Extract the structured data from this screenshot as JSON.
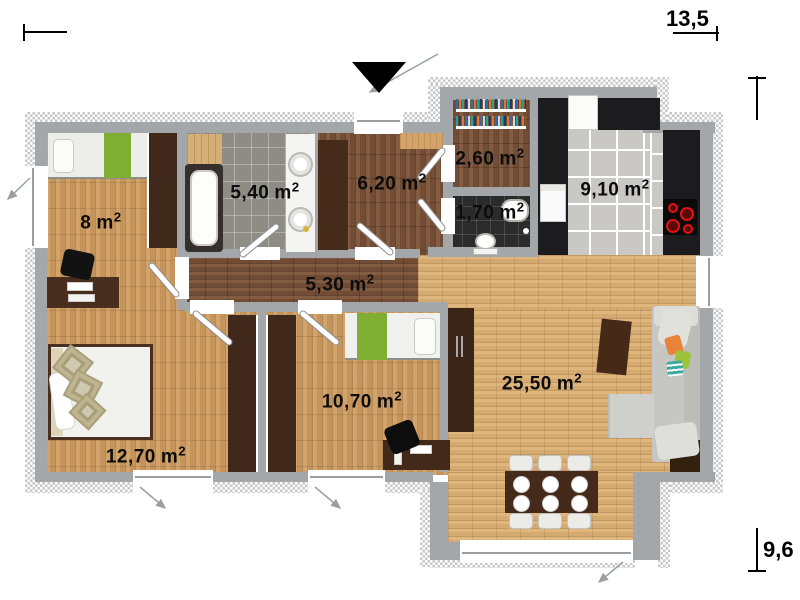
{
  "plan": {
    "type": "house-floor-plan",
    "overall_dimensions": {
      "width_m": "13,5",
      "depth_m": "9,6"
    },
    "rooms": [
      {
        "id": "bedroom-1",
        "area": "8",
        "unit": "m",
        "exponent": "2"
      },
      {
        "id": "bathroom",
        "area": "5,40",
        "unit": "m",
        "exponent": "2"
      },
      {
        "id": "entrance-hall",
        "area": "6,20",
        "unit": "m",
        "exponent": "2"
      },
      {
        "id": "walk-in-closet",
        "area": "2,60",
        "unit": "m",
        "exponent": "2"
      },
      {
        "id": "wc",
        "area": "1,70",
        "unit": "m",
        "exponent": "2"
      },
      {
        "id": "kitchen",
        "area": "9,10",
        "unit": "m",
        "exponent": "2"
      },
      {
        "id": "corridor",
        "area": "5,30",
        "unit": "m",
        "exponent": "2"
      },
      {
        "id": "bedroom-2",
        "area": "12,70",
        "unit": "m",
        "exponent": "2"
      },
      {
        "id": "bedroom-3",
        "area": "10,70",
        "unit": "m",
        "exponent": "2"
      },
      {
        "id": "living-room",
        "area": "25,50",
        "unit": "m",
        "exponent": "2"
      }
    ],
    "icons": {
      "entrance_marker": "black-triangle-down",
      "door_swing": "white-diagonal-door-leaf",
      "window_opening_arrow": "thin-diagonal-arrow"
    },
    "colors": {
      "wall_gray": "#a3a7aa",
      "insulation_hatch": "#c8c8c8",
      "oak_floor": "#cf9c60",
      "light_oak_floor": "#ddb174",
      "walnut_floor": "#7c5338",
      "furniture_dark_wood": "#40291b",
      "accent_green": "#7fae33",
      "cooktop_red": "#e21313",
      "kitchen_counter_black": "#1c1c1e"
    }
  }
}
